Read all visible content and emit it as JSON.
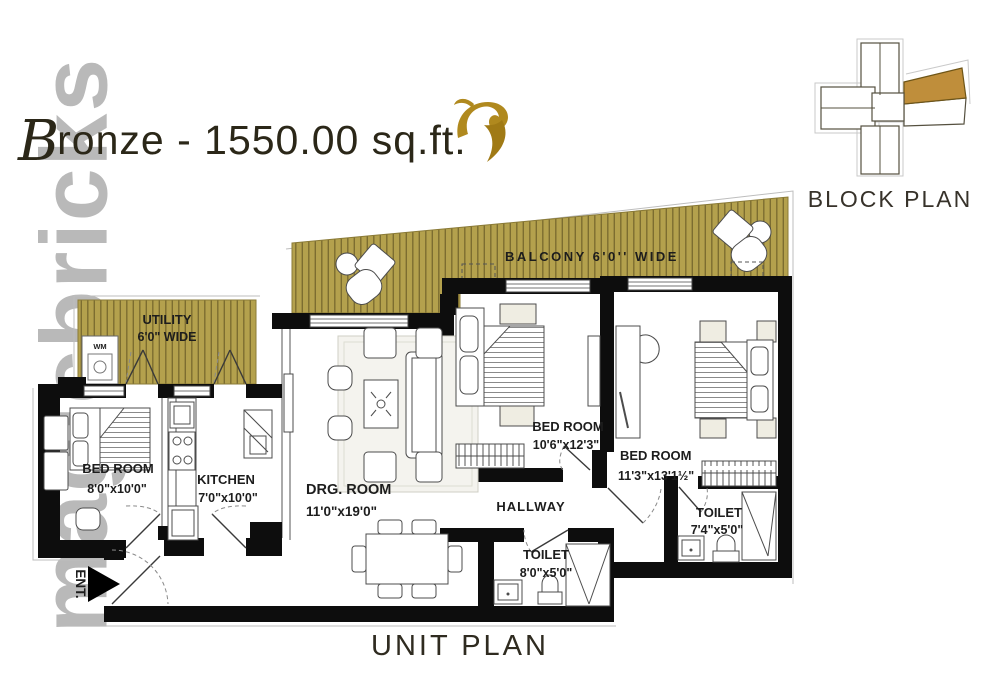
{
  "watermark": "magicbricks",
  "title": {
    "initial": "B",
    "rest": "ronze - 1550.00 sq.ft."
  },
  "block_plan": {
    "label": "BLOCK PLAN"
  },
  "unit_plan": {
    "label": "UNIT PLAN"
  },
  "entrance": {
    "label": "ENT."
  },
  "rooms": {
    "balcony": {
      "label": "BALCONY 6'0'' WIDE"
    },
    "utility": {
      "name": "UTILITY",
      "dims": "6'0\" WIDE"
    },
    "bedroom1": {
      "name": "BED ROOM",
      "dims": "8'0\"x10'0\""
    },
    "kitchen": {
      "name": "KITCHEN",
      "dims": "7'0\"x10'0\""
    },
    "drawing_room": {
      "name": "DRG. ROOM",
      "dims": "11'0\"x19'0\""
    },
    "bedroom2": {
      "name": "BED ROOM",
      "dims": "10'6\"x12'3\""
    },
    "bedroom3": {
      "name": "BED ROOM",
      "dims": "11'3\"x13'1½\""
    },
    "hallway": {
      "name": "HALLWAY"
    },
    "toilet1": {
      "name": "TOILET",
      "dims": "8'0\"x5'0\""
    },
    "toilet2": {
      "name": "TOILET",
      "dims": "7'4\"x5'0\""
    }
  },
  "fixtures": {
    "washing_machine": "WM"
  },
  "colors": {
    "balcony_gold": "#b4a14d",
    "stripe_dark": "#7c6d30",
    "block_highlight": "#bf8e3b",
    "flourish_gold": "#b0891e",
    "wall_black": "#0d0d0d",
    "text_dark": "#2b2718",
    "watermark_gray": "#b9b9b9"
  }
}
